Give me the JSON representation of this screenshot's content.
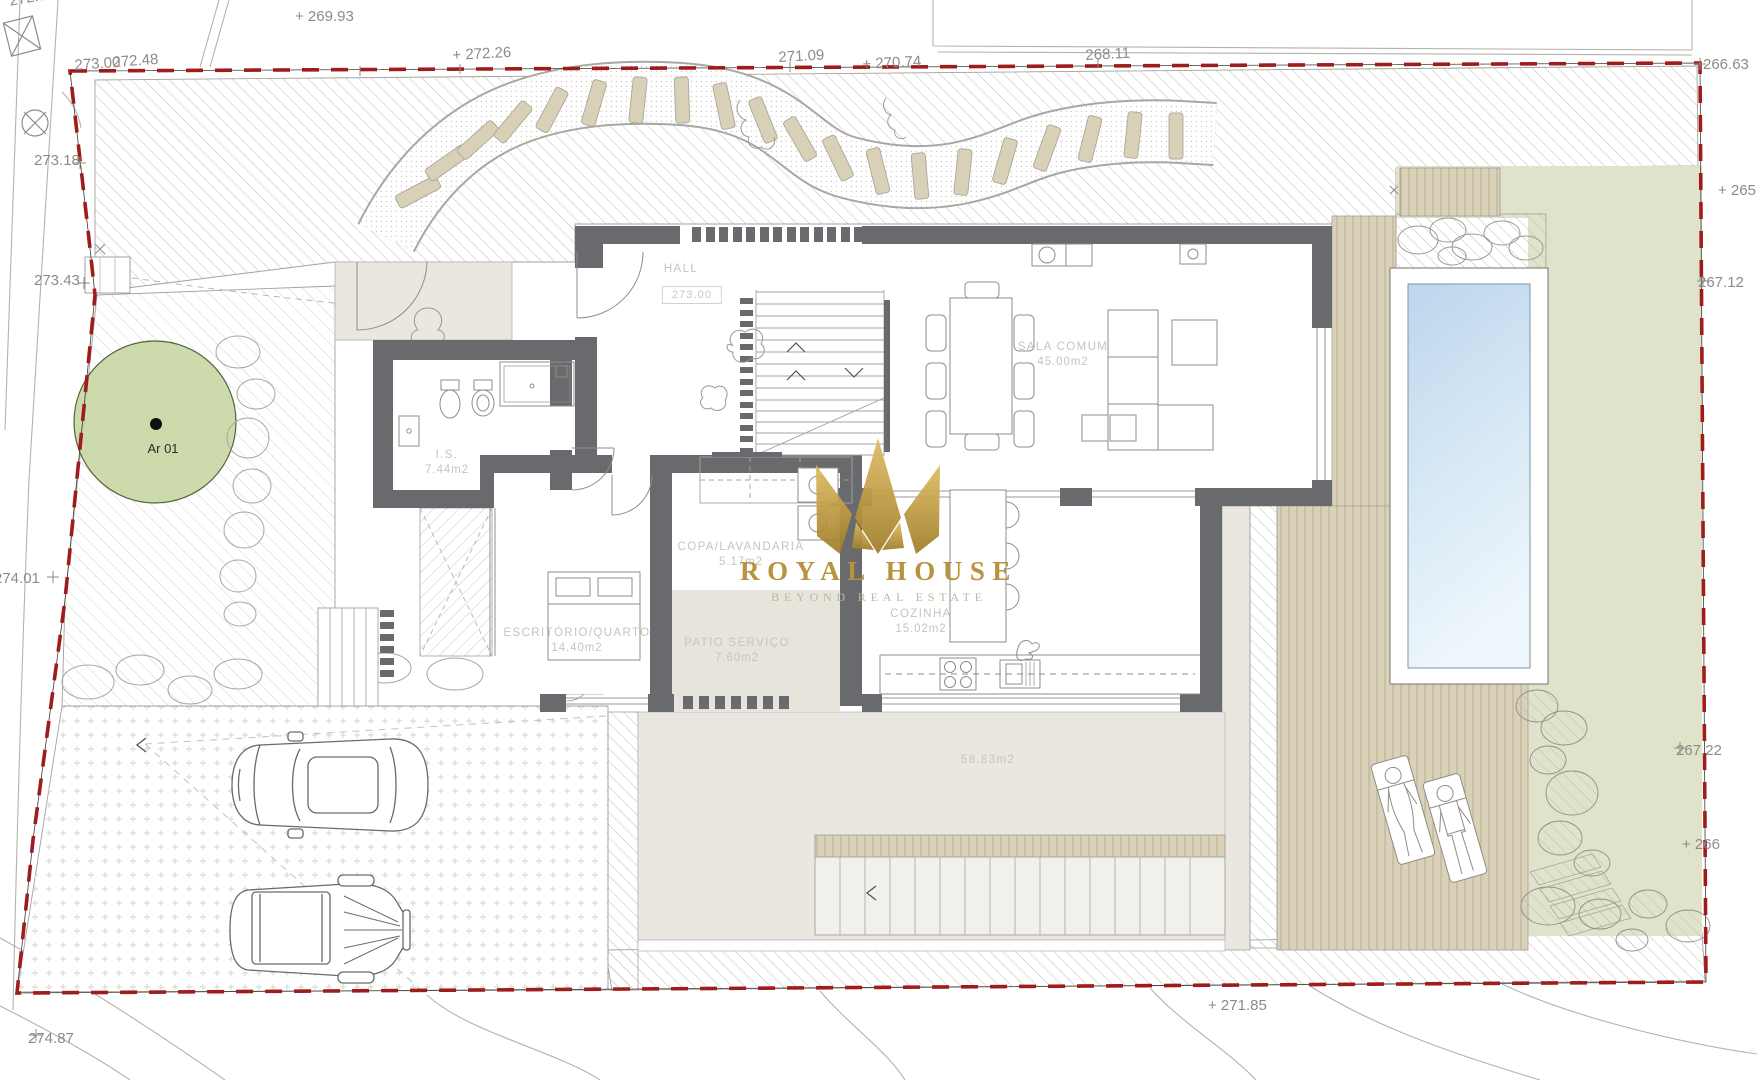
{
  "watermark": {
    "brand": "ROYAL HOUSE",
    "tagline": "BEYOND REAL ESTATE"
  },
  "site": {
    "tree_label": "Ar 01",
    "hall_level": "273.00",
    "terrace_area": "58.83m2"
  },
  "rooms": {
    "hall": {
      "name": "HALL"
    },
    "sala": {
      "name": "SALA  COMUM",
      "area": "45.00m2"
    },
    "is": {
      "name": "I.S.",
      "area": "7.44m2"
    },
    "office": {
      "name": "ESCRITÓRIO/QUARTO",
      "area": "14.40m2"
    },
    "copa": {
      "name": "COPA/LAVANDARIA",
      "area": "5.17m2"
    },
    "patio": {
      "name": "PATIO  SERVIÇO",
      "area": "7.60m2"
    },
    "cozinha": {
      "name": "COZINHA",
      "area": "15.02m2"
    }
  },
  "elevations": {
    "e27283": "272.83",
    "e26993": "+ 269.93",
    "e27300": "273.00",
    "e27248": "272.48",
    "e27226": "+ 272.26",
    "e27109": "271.09",
    "e27074": "+ 270.74",
    "e26811": "268.11",
    "e26663": "266.63",
    "e265": "+ 265",
    "e26712": "267.12",
    "e26722": "267.22",
    "e266": "+ 266",
    "e27318": "273.18",
    "e27343": "273.43",
    "e27401": "274.01",
    "e27487": "274.87",
    "e27185": "+ 271.85"
  },
  "colors": {
    "boundary": "#9e1c1c",
    "wall": "#696a6d",
    "grass": "#e0e3ca",
    "deck": "#d9d1b8",
    "gold": "#b8923f",
    "pool": "#c2daee"
  }
}
